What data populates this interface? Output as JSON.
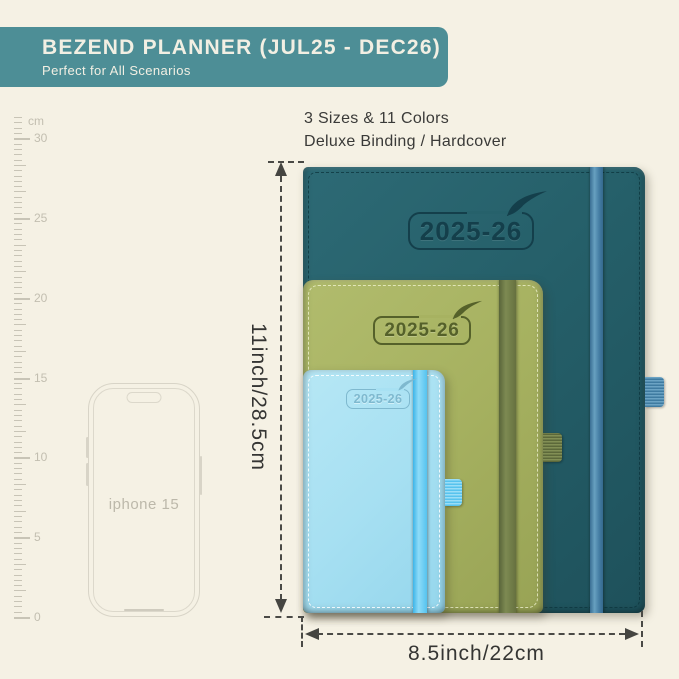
{
  "header": {
    "title": "BEZEND PLANNER (JUL25 - DEC26)",
    "subtitle": "Perfect for All Scenarios",
    "bg_color": "#4d8e96",
    "text_color": "#f2efe3"
  },
  "info": {
    "line1": "3 Sizes & 11 Colors",
    "line2": "Deluxe Binding / Hardcover"
  },
  "ruler": {
    "unit": "cm",
    "major_labels": [
      "30",
      "25",
      "20",
      "15",
      "10",
      "5",
      "0"
    ]
  },
  "phone": {
    "label": "iphone 15"
  },
  "planners": {
    "large": {
      "year_label": "2025-26",
      "cover_color": "#26616b",
      "band_color": "#4a81a6",
      "size_note": "largest, dark teal"
    },
    "medium": {
      "year_label": "2025-26",
      "cover_color": "#a7b261",
      "band_color": "#66713c",
      "size_note": "medium, olive green"
    },
    "small": {
      "year_label": "2025-26",
      "cover_color": "#a8e1f3",
      "band_color": "#55c6f1",
      "size_note": "smallest, light blue"
    }
  },
  "dimensions": {
    "height_label": "11inch/28.5cm",
    "width_label": "8.5inch/22cm"
  },
  "background_color": "#f5f1e4"
}
